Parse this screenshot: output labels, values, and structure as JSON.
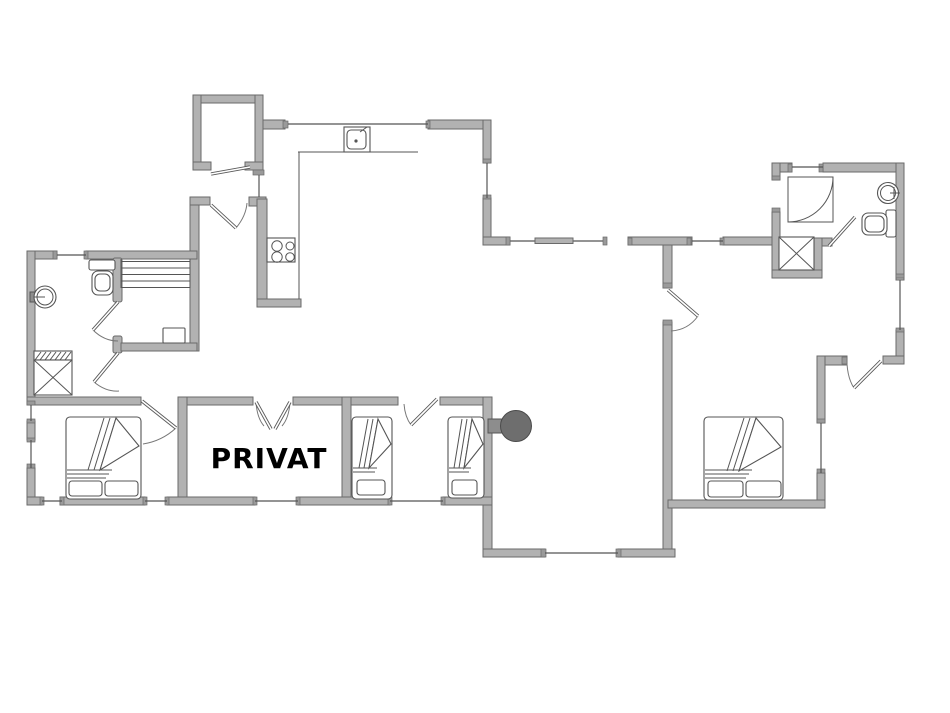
{
  "floorplan": {
    "labels": {
      "private_room": "PRIVAT"
    },
    "colors": {
      "background": "#ffffff",
      "wall-fill": "#b2b2b2",
      "wall-stroke": "#6a6a6a",
      "thin-line": "#555555",
      "stove-fill": "#6e6e6e",
      "label-color": "#000000"
    },
    "fixtures": [
      "kitchen-sink",
      "stove-cooktop",
      "bathroom-sink-left",
      "toilet-left",
      "sauna-benches",
      "sauna-heater",
      "shower-tray-left",
      "double-bed-left",
      "single-bed-1",
      "single-bed-2",
      "double-bed-right",
      "wood-stove",
      "corner-shower-right",
      "shower-tray-right",
      "bathroom-sink-right",
      "toilet-right"
    ]
  }
}
